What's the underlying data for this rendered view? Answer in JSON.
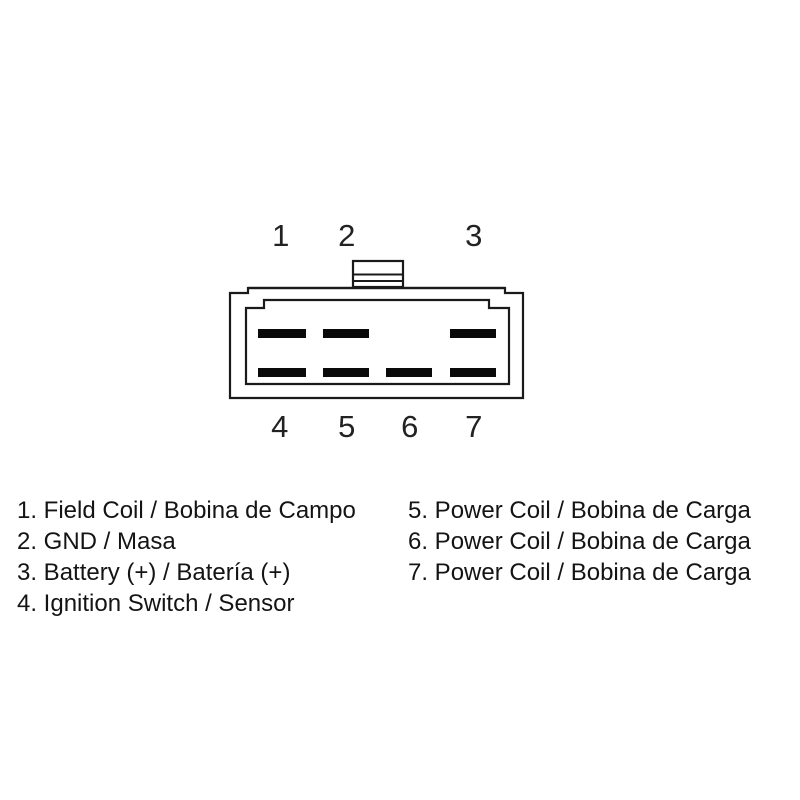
{
  "connector": {
    "description": "7-pin connector front view with latch tab",
    "pin_labels_top": [
      "1",
      "2",
      "3"
    ],
    "pin_labels_bottom": [
      "4",
      "5",
      "6",
      "7"
    ]
  },
  "legend": {
    "left_items": [
      "1. Field Coil / Bobina de Campo",
      "2. GND / Masa",
      "3. Battery (+) / Batería (+)",
      "4. Ignition Switch / Sensor"
    ],
    "right_items": [
      "5. Power Coil / Bobina de Carga",
      "6. Power Coil / Bobina de Carga",
      "7. Power Coil / Bobina de Carga"
    ]
  },
  "colors": {
    "line": "#1a1a1a",
    "pin_fill": "#0a0a0a",
    "background": "#ffffff",
    "text": "#141414"
  }
}
